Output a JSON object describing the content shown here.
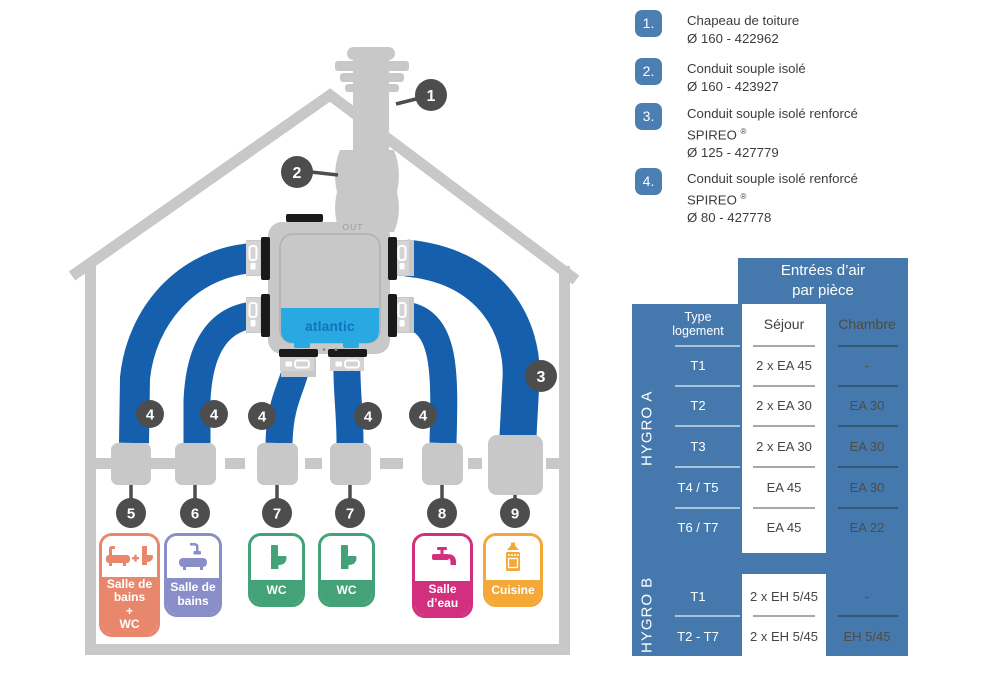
{
  "colors": {
    "duct_blue": "#165FAC",
    "structure_gray": "#C8C8C8",
    "callout_dark": "#4D4D4D",
    "table_blue": "#4579AD",
    "legend_badge_blue": "#4B7EB2",
    "unit_panel_blue": "#29A9E1",
    "atlantic_text_blue": "#1272BF",
    "room_salle_de_bains_wc": "#E8876C",
    "room_salle_de_bains": "#8A8EC8",
    "room_wc": "#43A277",
    "room_salle_d_eau": "#D2307E",
    "room_cuisine": "#F3A838"
  },
  "diagram": {
    "unit": {
      "brand": "atlantic",
      "out_label": "OUT"
    },
    "callout_numbers": {
      "n1": "1",
      "n2": "2",
      "n3": "3",
      "n4": "4",
      "n5": "5",
      "n6": "6",
      "n7": "7",
      "n8": "8",
      "n9": "9"
    },
    "rooms": [
      {
        "id": "salle-de-bains-wc",
        "lines": [
          "Salle de",
          "bains",
          "+",
          "WC"
        ]
      },
      {
        "id": "salle-de-bains",
        "lines": [
          "Salle de",
          "bains"
        ]
      },
      {
        "id": "wc-1",
        "lines": [
          "WC"
        ]
      },
      {
        "id": "wc-2",
        "lines": [
          "WC"
        ]
      },
      {
        "id": "salle-d-eau",
        "lines": [
          "Salle",
          "d’eau"
        ]
      },
      {
        "id": "cuisine",
        "lines": [
          "Cuisine"
        ]
      }
    ]
  },
  "legend": {
    "reg_mark": "®",
    "items": [
      {
        "num": "1.",
        "title": "Chapeau de toiture",
        "product": "",
        "ref": "Ø 160  - 422962"
      },
      {
        "num": "2.",
        "title": "Conduit souple isolé",
        "product": "",
        "ref": "Ø 160  - 423927"
      },
      {
        "num": "3.",
        "title": "Conduit souple isolé renforcé",
        "product": "SPIREO",
        "ref": "Ø 125 - 427779"
      },
      {
        "num": "4.",
        "title": "Conduit souple isolé renforcé",
        "product": "SPIREO",
        "ref": "Ø 80  - 427778"
      }
    ]
  },
  "table": {
    "header_line1": "Entrées d’air",
    "header_line2": "par pièce",
    "col_type_line1": "Type",
    "col_type_line2": "logement",
    "col_sejour": "Séjour",
    "col_chambre": "Chambre",
    "hygro_a": {
      "label": "HYGRO A",
      "rows": [
        {
          "type": "T1",
          "sejour": "2 x EA 45",
          "chambre": "-"
        },
        {
          "type": "T2",
          "sejour": "2 x EA 30",
          "chambre": "EA 30"
        },
        {
          "type": "T3",
          "sejour": "2 x EA 30",
          "chambre": "EA 30"
        },
        {
          "type": "T4 / T5",
          "sejour": "EA 45",
          "chambre": "EA 30"
        },
        {
          "type": "T6 / T7",
          "sejour": "EA 45",
          "chambre": "EA 22"
        }
      ]
    },
    "hygro_b": {
      "label": "HYGRO B",
      "rows": [
        {
          "type": "T1",
          "sejour": "2 x EH 5/45",
          "chambre": "-"
        },
        {
          "type": "T2 - T7",
          "sejour": "2 x EH 5/45",
          "chambre": "EH 5/45"
        }
      ]
    }
  }
}
